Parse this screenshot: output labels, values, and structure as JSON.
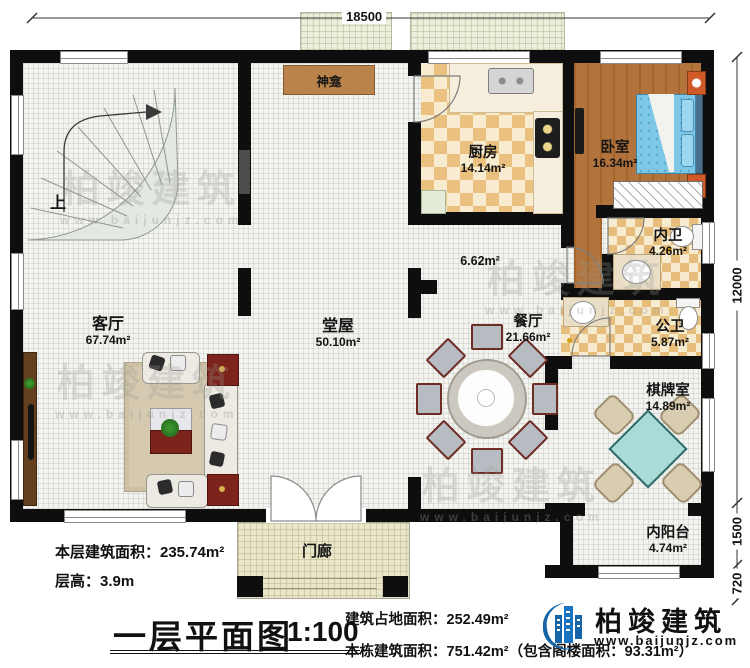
{
  "dimensions": {
    "top_width": "18500",
    "right_height": "12000",
    "right_balcony": "1500",
    "right_step": "720"
  },
  "rooms": {
    "living": {
      "name": "客厅",
      "area": "67.74m²"
    },
    "hall": {
      "name": "堂屋",
      "area": "50.10m²"
    },
    "kitchen": {
      "name": "厨房",
      "area": "14.14m²"
    },
    "bedroom": {
      "name": "卧室",
      "area": "16.34m²"
    },
    "ensuite": {
      "name": "内卫",
      "area": "4.26m²"
    },
    "publicbath": {
      "name": "公卫",
      "area": "5.87m²"
    },
    "dining": {
      "name": "餐厅",
      "area": "21.66m²"
    },
    "chess": {
      "name": "棋牌室",
      "area": "14.89m²"
    },
    "balcony": {
      "name": "内阳台",
      "area": "4.74m²"
    },
    "porch": {
      "name": "门廊"
    },
    "shrine": {
      "name": "神龛"
    },
    "corridor": {
      "area": "6.62m²"
    },
    "stairs": {
      "direction": "上"
    }
  },
  "footer": {
    "floor_area": "本层建筑面积：235.74m²",
    "floor_height": "层高：3.9m",
    "plan_title": "一层平面图",
    "scale": "1:100",
    "land_area": "建筑占地面积：252.49m²",
    "total_area": "本栋建筑面积：751.42m²（包含阁楼面积：93.31m²）"
  },
  "brand": {
    "name": "柏竣建筑",
    "website": "www.baijunjz.com",
    "color": "#1565a8"
  },
  "watermark": {
    "text": "柏竣建筑",
    "website": "www.baijunjz.com"
  }
}
